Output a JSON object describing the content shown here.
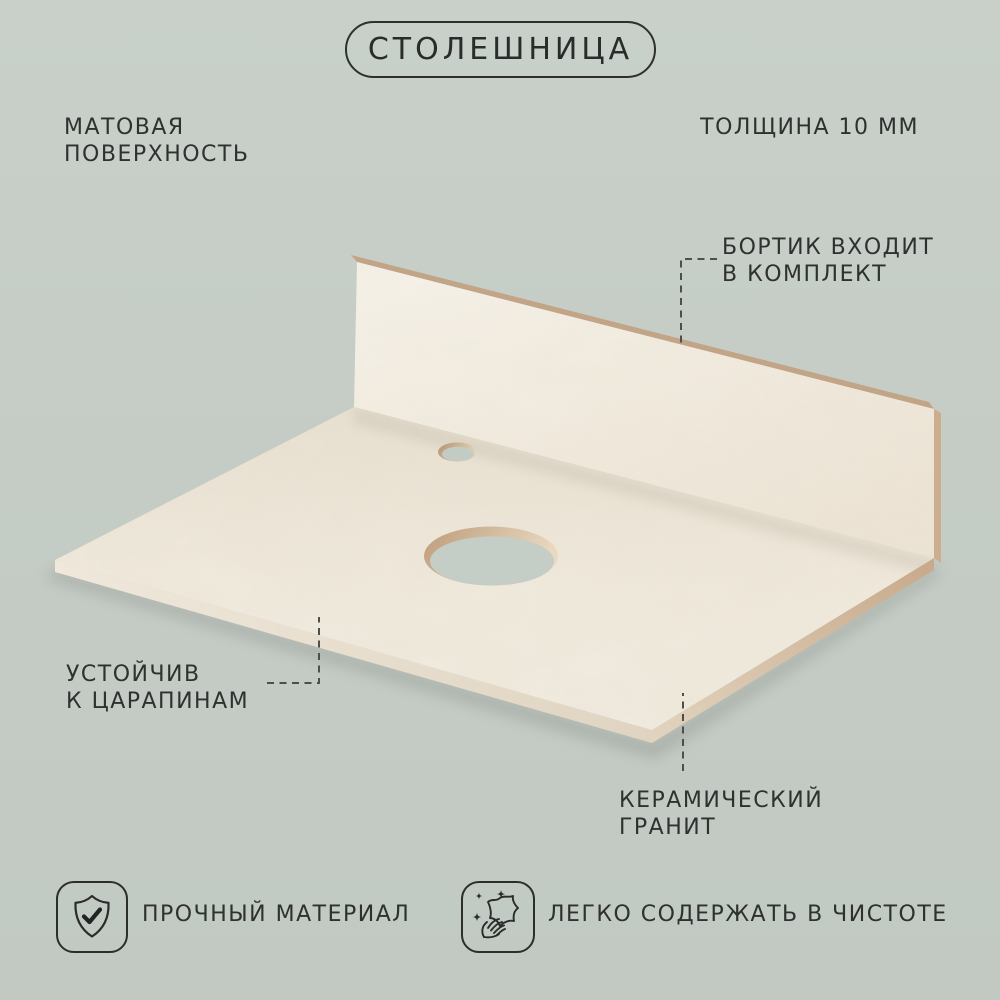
{
  "title": "СТОЛЕШНИЦА",
  "annotations": {
    "surface": {
      "line1": "МАТОВАЯ",
      "line2": "ПОВЕРХНОСТЬ"
    },
    "thickness": {
      "label": "ТОЛЩИНА 10 ММ"
    },
    "backsplash": {
      "line1": "БОРТИК ВХОДИТ",
      "line2": "В КОМПЛЕКТ"
    },
    "scratch": {
      "line1": "УСТОЙЧИВ",
      "line2": "К ЦАРАПИНАМ"
    },
    "material": {
      "line1": "КЕРАМИЧЕСКИЙ",
      "line2": "ГРАНИТ"
    }
  },
  "badges": [
    {
      "icon": "shield-check-icon",
      "label": "ПРОЧНЫЙ МАТЕРИАЛ"
    },
    {
      "icon": "sparkle-wipe-icon",
      "label": "ЛЕГКО СОДЕРЖАТЬ В ЧИСТОТЕ"
    }
  ],
  "colors": {
    "background": "#c5ccc6",
    "text": "#2f3130",
    "marble_light": "#f4f0e7",
    "marble_mid": "#ece4d6",
    "edge_tan": "#c6a98c",
    "callout_line": "#4c504d"
  }
}
